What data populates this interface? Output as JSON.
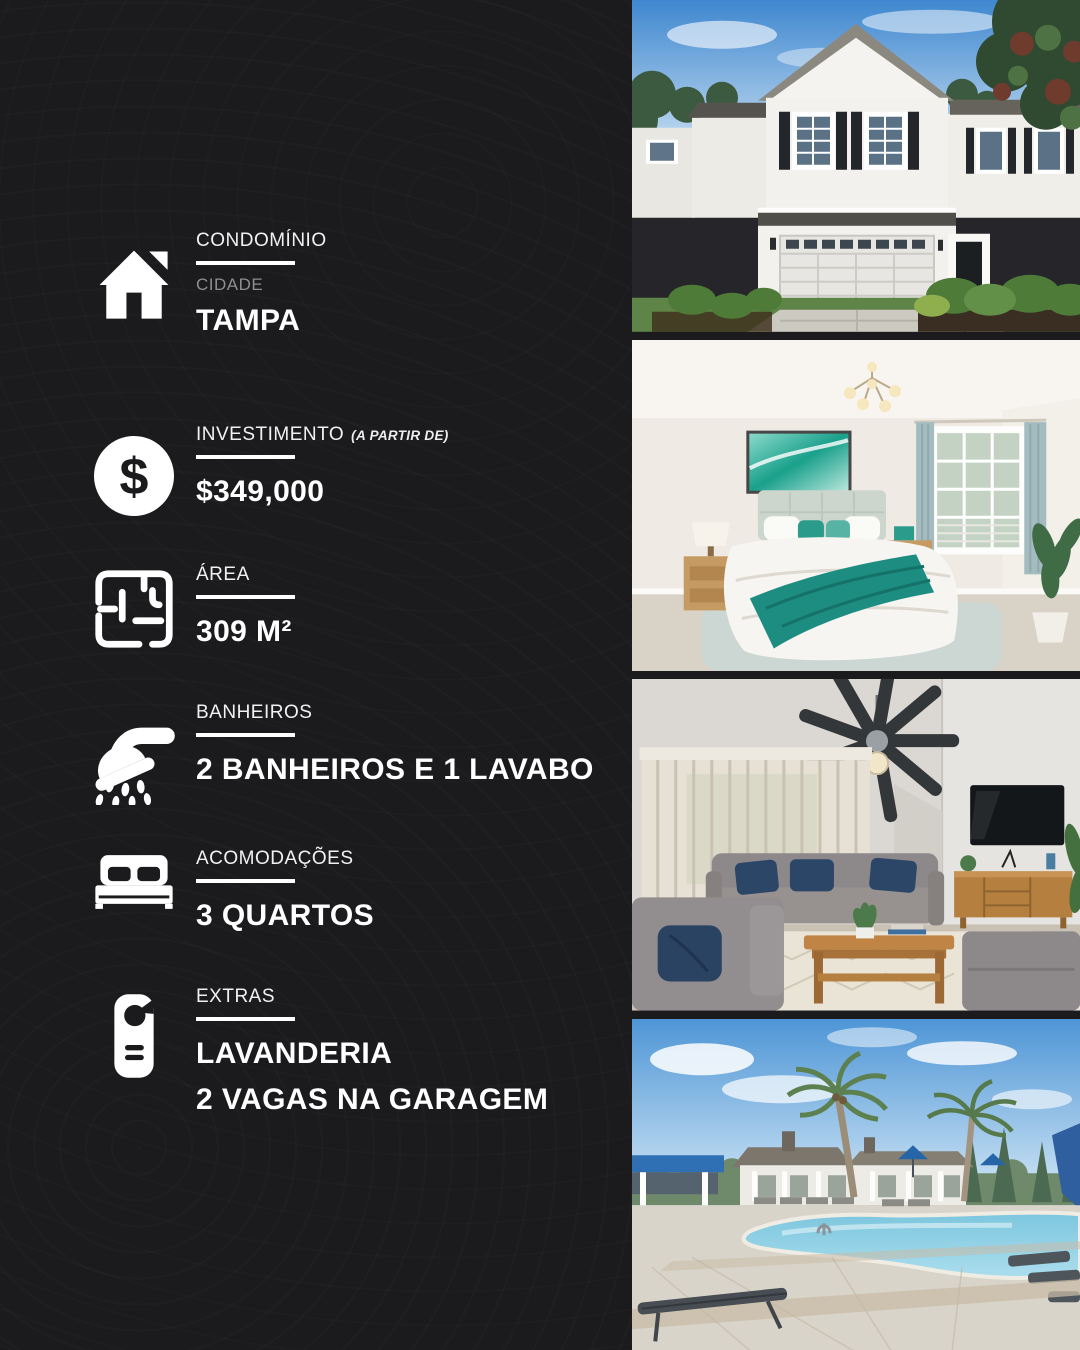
{
  "theme": {
    "background": "#1b1b1d",
    "text_primary": "#ffffff",
    "text_secondary": "#8e8e8e",
    "accent_rule": "#ffffff"
  },
  "sections": [
    {
      "id": "condominio",
      "icon": "house-icon",
      "label": "CONDOMÍNIO",
      "sublabel": "CIDADE",
      "value": "TAMPA"
    },
    {
      "id": "investimento",
      "icon": "dollar-sign-icon",
      "label": "INVESTIMENTO",
      "label_note": "(A PARTIR DE)",
      "value": "$349,000"
    },
    {
      "id": "area",
      "icon": "floor-plan-icon",
      "label": "ÁREA",
      "value": "309 M²"
    },
    {
      "id": "banheiros",
      "icon": "shower-icon",
      "label": "BANHEIROS",
      "value": "2 BANHEIROS E 1 LAVABO"
    },
    {
      "id": "acomodacoes",
      "icon": "bed-icon",
      "label": "ACOMODAÇÕES",
      "value": "3 QUARTOS"
    },
    {
      "id": "extras",
      "icon": "door-hanger-icon",
      "label": "EXTRAS",
      "value_lines": [
        "LAVANDERIA",
        "2 VAGAS NA GARAGEM"
      ]
    }
  ],
  "photos": [
    {
      "name": "house-exterior-photo"
    },
    {
      "name": "bedroom-photo"
    },
    {
      "name": "living-room-photo"
    },
    {
      "name": "community-pool-photo"
    }
  ]
}
